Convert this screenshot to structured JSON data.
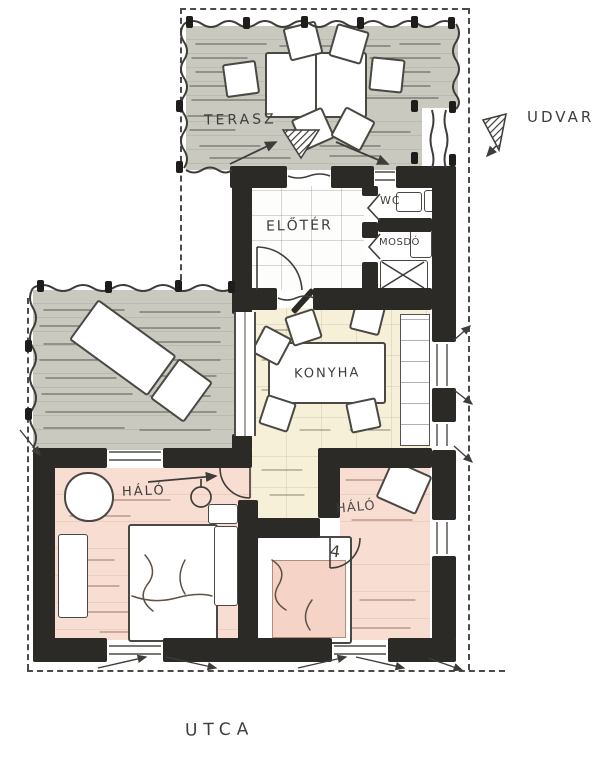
{
  "labels": {
    "terasz": "TERASZ",
    "udvar": "UDVAR",
    "eloter": "ELŐTÉR",
    "wc": "WC",
    "mosdo": "MOSDÓ",
    "konyha": "KONYHA",
    "halo_left": "HÁLÓ",
    "halo_right": "HÁLÓ",
    "utca": "UTCA",
    "bed_mark": "4"
  },
  "colors": {
    "terrace_floor": "#c9c9c0",
    "kitchen_floor": "#f6f0d8",
    "bedroom_floor": "#f8ddd2",
    "wall": "#2b2a27",
    "ink": "#3f3d39",
    "paper": "#ffffff"
  },
  "rooms": [
    {
      "id": "terasz",
      "label": "TERASZ",
      "fill": "#c9c9c0"
    },
    {
      "id": "eloter",
      "label": "ELŐTÉR",
      "fill": "#ffffff"
    },
    {
      "id": "wc",
      "label": "WC",
      "fill": "#ffffff"
    },
    {
      "id": "mosdo",
      "label": "MOSDÓ",
      "fill": "#ffffff"
    },
    {
      "id": "konyha",
      "label": "KONYHA",
      "fill": "#f6f0d8"
    },
    {
      "id": "halo-left",
      "label": "HÁLÓ",
      "fill": "#f8ddd2"
    },
    {
      "id": "halo-right",
      "label": "HÁLÓ",
      "fill": "#f8ddd2"
    },
    {
      "id": "oldalterasz",
      "label": "",
      "fill": "#c9c9c0"
    }
  ],
  "outside_labels": [
    {
      "id": "udvar",
      "label": "UDVAR"
    },
    {
      "id": "utca",
      "label": "UTCA"
    }
  ]
}
